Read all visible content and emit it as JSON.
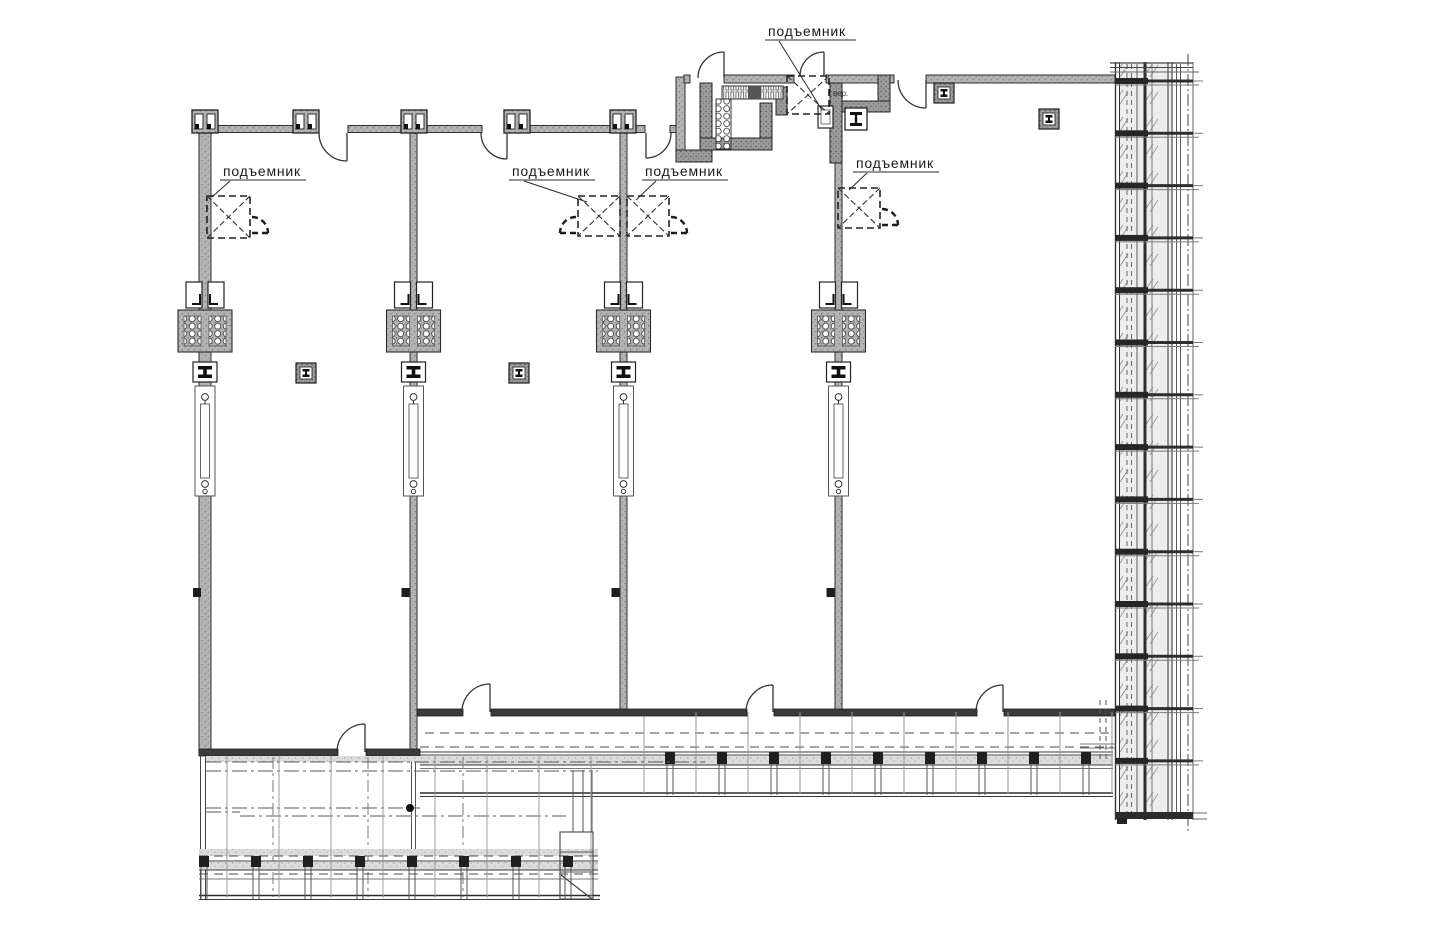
{
  "page": {
    "background": "#ffffff"
  },
  "plan": {
    "type": "architectural-floor-plan",
    "language": "ru",
    "labels": [
      {
        "id": "hoist-top",
        "text": "подъемник"
      },
      {
        "id": "hoist-left",
        "text": "подъемник"
      },
      {
        "id": "hoist-mid-left",
        "text": "подъемник"
      },
      {
        "id": "hoist-mid-right",
        "text": "подъемник"
      },
      {
        "id": "hoist-right",
        "text": "подъемник"
      }
    ],
    "annotations": [
      {
        "id": "small-note",
        "text": "вер."
      }
    ],
    "colors": {
      "line": "#3a3a3a",
      "wall_fill": "#b4b4b4",
      "wall_dark": "#9b9b9b",
      "glass_fill": "#ededed",
      "hatch": "#9c9c9c",
      "label_text": "#1b1b1b"
    }
  }
}
